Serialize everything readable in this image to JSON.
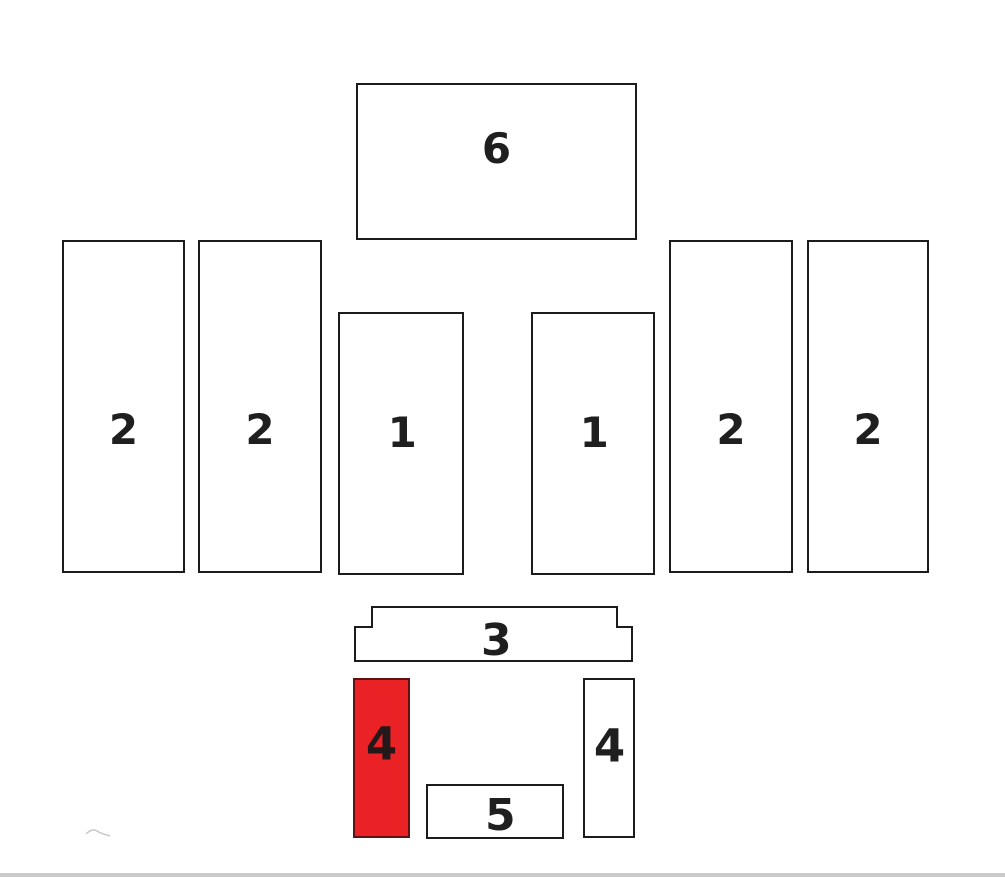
{
  "diagram": {
    "type": "parts-location-diagram",
    "background": "#ffffff",
    "outline_color": "#1c1c1c",
    "label_color": "#1f1f1f",
    "highlight_color": "#ea2226",
    "highlight_border_color": "#5d1214",
    "baseline_color": "#cacaca",
    "panels": [
      {
        "id": "panel-6",
        "label": "6",
        "highlighted": false
      },
      {
        "id": "panel-2-far-left",
        "label": "2",
        "highlighted": false
      },
      {
        "id": "panel-2-left",
        "label": "2",
        "highlighted": false
      },
      {
        "id": "panel-1-left",
        "label": "1",
        "highlighted": false
      },
      {
        "id": "panel-1-right",
        "label": "1",
        "highlighted": false
      },
      {
        "id": "panel-2-right",
        "label": "2",
        "highlighted": false
      },
      {
        "id": "panel-2-far-right",
        "label": "2",
        "highlighted": false
      },
      {
        "id": "panel-3",
        "label": "3",
        "highlighted": false
      },
      {
        "id": "panel-4-left",
        "label": "4",
        "highlighted": true
      },
      {
        "id": "panel-5",
        "label": "5",
        "highlighted": false
      },
      {
        "id": "panel-4-right",
        "label": "4",
        "highlighted": false
      }
    ]
  }
}
